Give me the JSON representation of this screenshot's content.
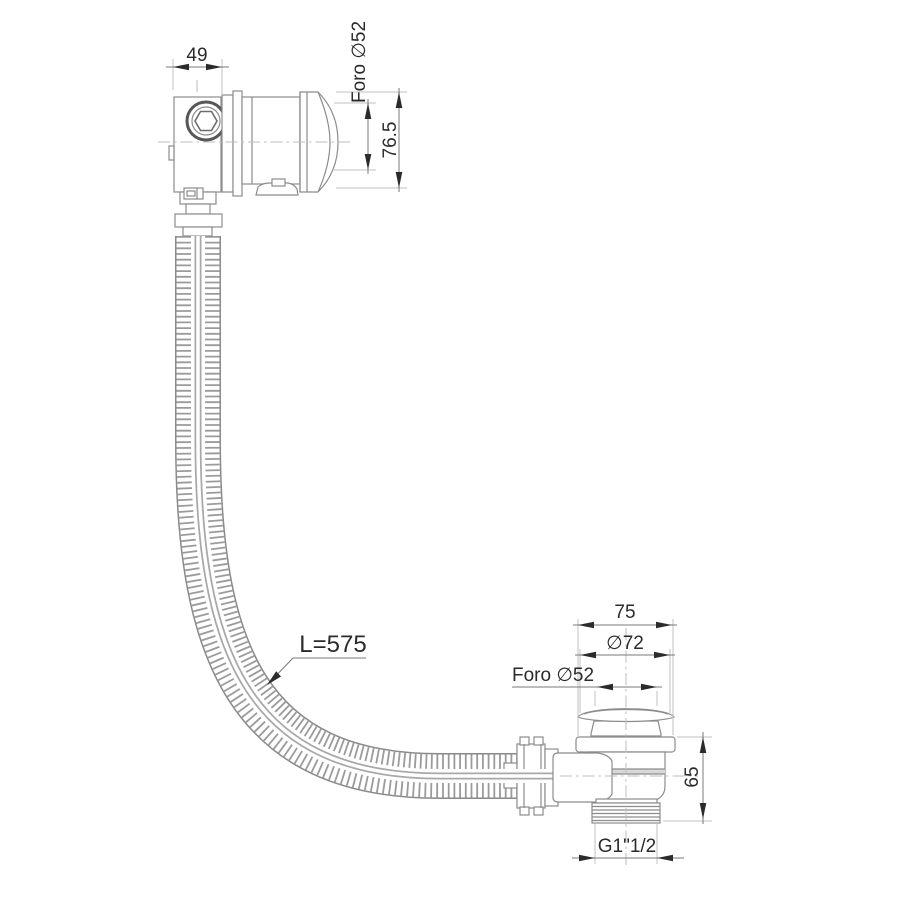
{
  "drawing_type": "technical line drawing of bathtub waste-overflow kit with flexible corrugated hose",
  "colors": {
    "background": "#ffffff",
    "part_line": "#8c8c8c",
    "dimension_line": "#787878",
    "extension_line": "#c2c2c2",
    "text_and_arrows": "#2b2b2b",
    "hose_rib": "#9b9b9b"
  },
  "overflow": {
    "width_label": "49",
    "hole_label": "Foro ∅52",
    "height_label": "76.5"
  },
  "hose": {
    "length_label": "L=575"
  },
  "drain": {
    "flange_label": "75",
    "cap_label": "∅72",
    "hole_label": "Foro ∅52",
    "height_label": "65",
    "thread_label": "G1\"1/2"
  }
}
